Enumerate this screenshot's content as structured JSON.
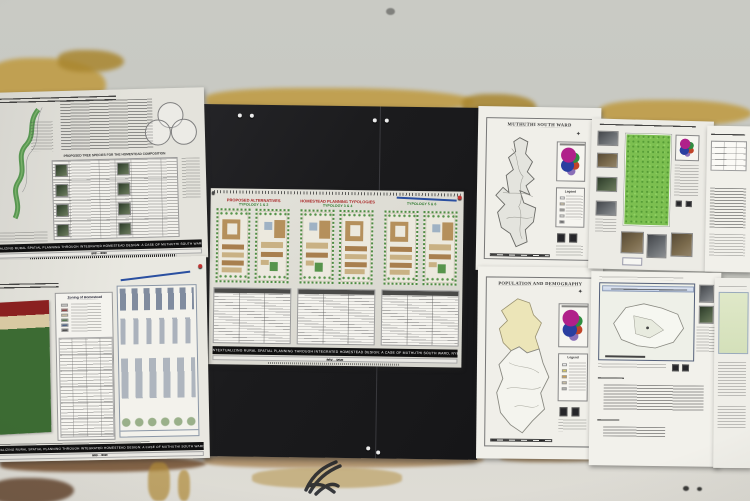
{
  "scene": {
    "setting": "Photograph of university planning-studio posters and ward maps pinned on a weathered wall and a black display board",
    "colors": {
      "wall": "#c8c9c3",
      "wall_stain_ochre": "#bf9a3f",
      "wall_stain_brown": "#6b4423",
      "display_board": "#1c1c1e",
      "paper": "#ecebe5",
      "banner_black": "#101010",
      "heading_red": "#a82424",
      "heading_green": "#2f7a2f",
      "plan_green": "#4e8c44",
      "plan_tan": "#b5905c",
      "zoning_red": "#8a2020",
      "zoning_cream": "#d8c9a2",
      "zoning_green": "#3c6b33",
      "inset_magenta": "#b0208a",
      "inset_blue": "#2a3ea0",
      "inset_green": "#2f8c3f",
      "legend_yellow": "#e8d44a",
      "legend_orange": "#e0a030",
      "satellite_green": "#7cbf50",
      "annotation_blue": "#2a4fa0"
    }
  },
  "banner": {
    "title": "CONTEXTUALIZING RURAL SPATIAL PLANNING THROUGH INTEGRATED HOMESTEAD DESIGN: A CASE OF MUTHUTHI SOUTH WARD, NYERI",
    "author_1": "B63/····/2020",
    "author_2": "B63/····/2020",
    "author_3": "B63/····/2020"
  },
  "poster_left_top": {
    "tree_table_title": "PROPOSED TREE SPECIES FOR THE HOMESTEAD COMPOSITION",
    "legend_label": "Legend"
  },
  "poster_left_bottom": {
    "zoning_title": "Zoning of Homestead"
  },
  "poster_center": {
    "col1_title": "PROPOSED ALTERNATIVES",
    "col1_subtitle": "TYPOLOGY 1 & 2",
    "col2_title": "HOMESTEAD PLANNING TYPOLOGIES",
    "col2_subtitle": "TYPOLOGY 3 & 4",
    "col3_subtitle": "TYPOLOGY 5 & 6"
  },
  "map_posters": {
    "south_ward_title": "MUTHUTHI SOUTH WARD",
    "demography_title": "POPULATION AND DEMOGRAPHY",
    "legend_label": "Legend"
  },
  "icons": {
    "compass_rose": "✦"
  }
}
